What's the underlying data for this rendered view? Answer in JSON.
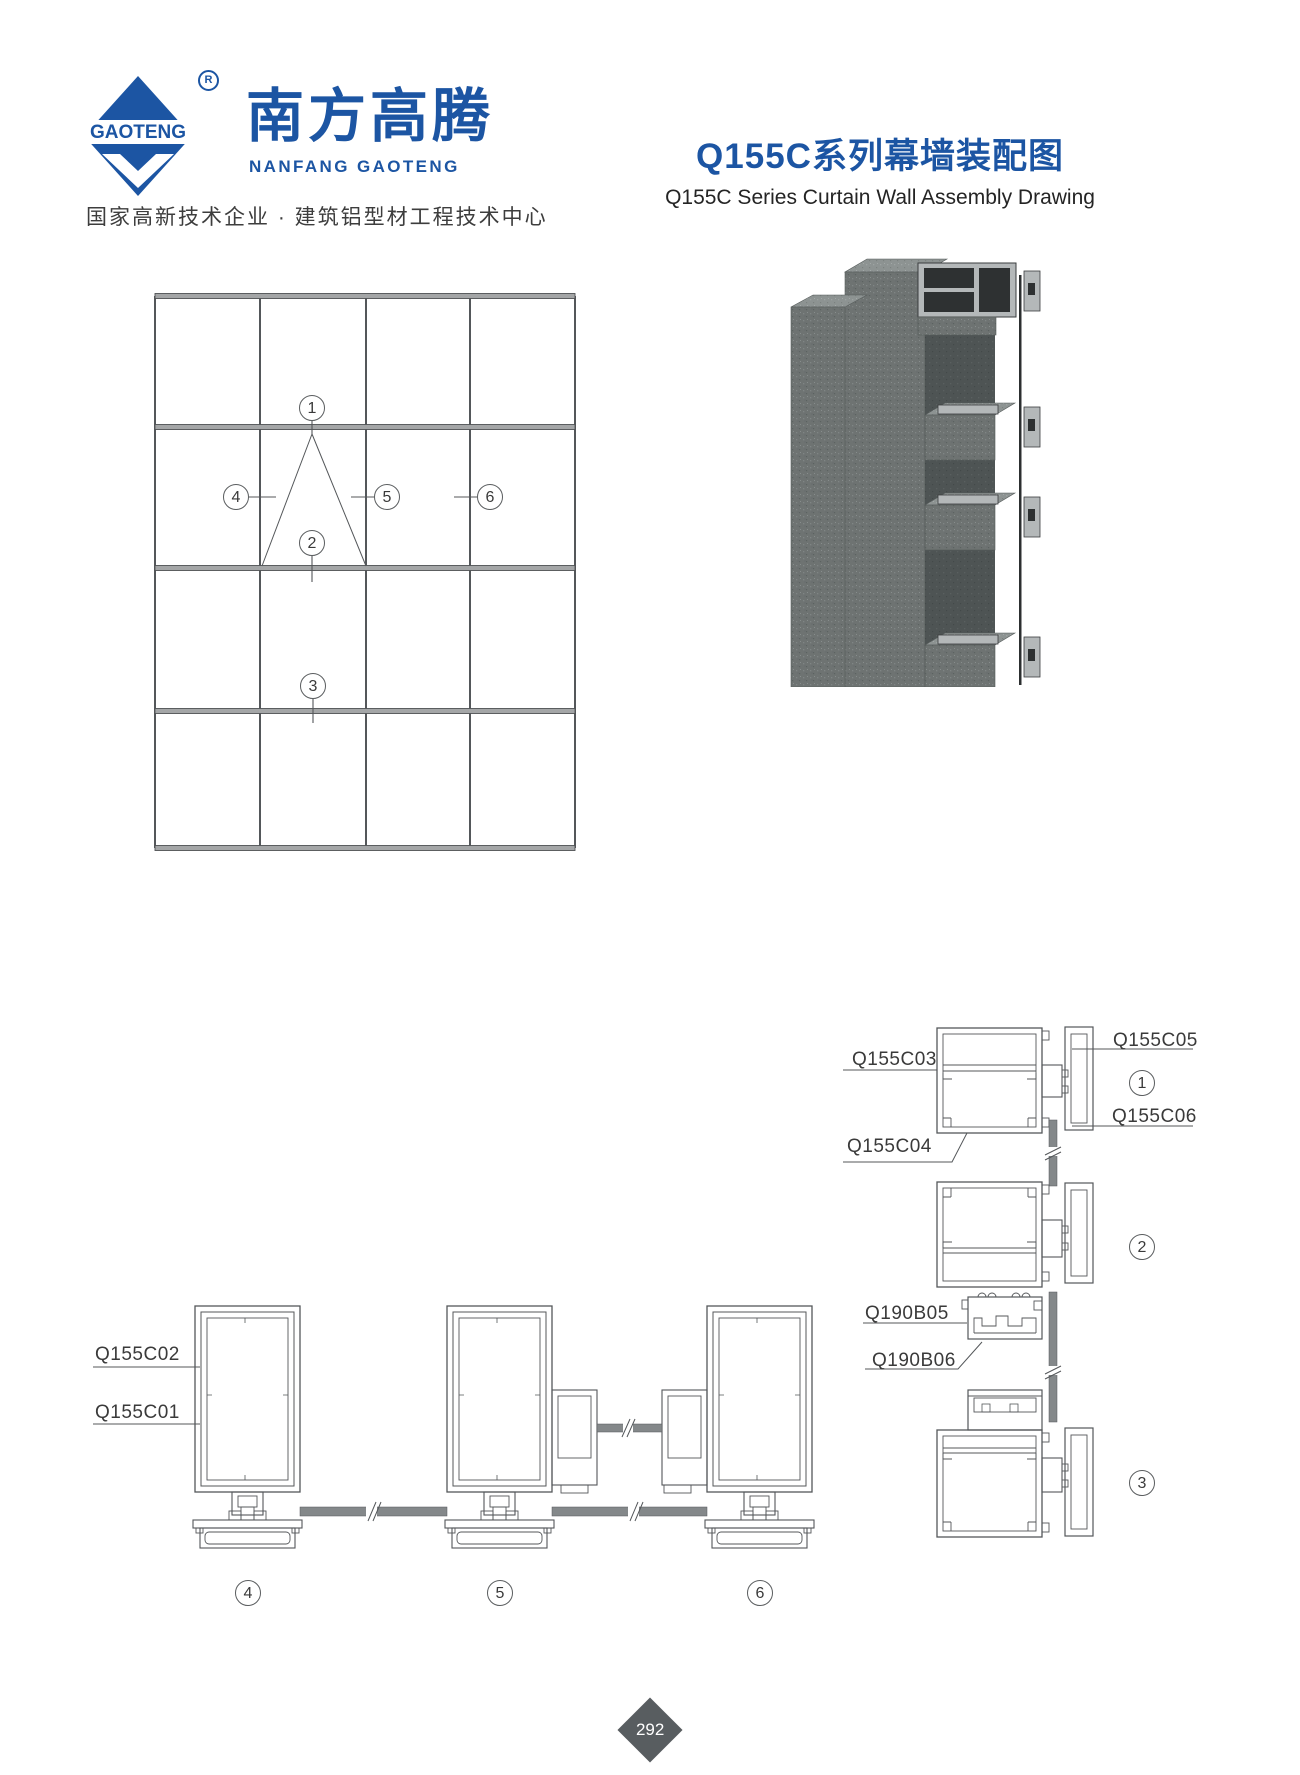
{
  "brand": {
    "logo_text": "GAOTENG",
    "registered_mark": "R",
    "name_cn": "南方高腾",
    "name_en": "NANFANG GAOTENG",
    "tagline": "国家高新技术企业 · 建筑铝型材工程技术中心"
  },
  "title": {
    "cn": "Q155C系列幕墙装配图",
    "en": "Q155C Series Curtain Wall Assembly Drawing"
  },
  "elevation": {
    "callouts": [
      "1",
      "2",
      "3",
      "4",
      "5",
      "6"
    ]
  },
  "section_callouts": {
    "c1": "1",
    "c2": "2",
    "c3": "3",
    "c4": "4",
    "c5": "5",
    "c6": "6"
  },
  "part_labels": {
    "q155c01": "Q155C01",
    "q155c02": "Q155C02",
    "q155c03": "Q155C03",
    "q155c04": "Q155C04",
    "q155c05": "Q155C05",
    "q155c06": "Q155C06",
    "q190b05": "Q190B05",
    "q190b06": "Q190B06"
  },
  "page": {
    "number": "292"
  },
  "colors": {
    "brand_blue": "#1c55a3",
    "line_dark": "#54575a",
    "glass_gray": "#84888a",
    "concrete_gray": "#6e7372",
    "aluminum_gray": "#b4b8b9",
    "page_diamond": "#585d60"
  }
}
